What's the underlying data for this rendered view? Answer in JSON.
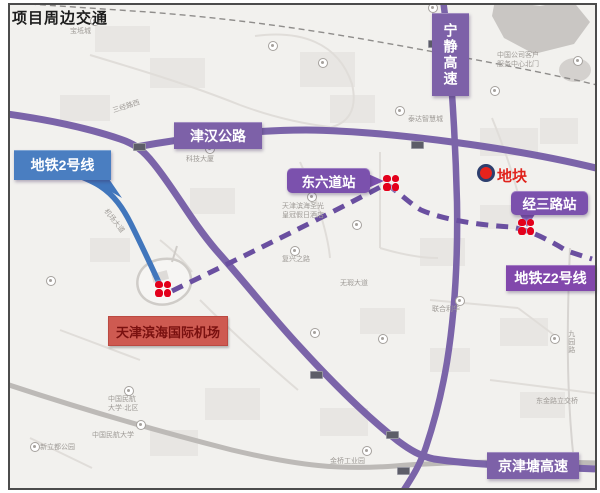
{
  "title": "项目周边交通",
  "labels": {
    "metro_line2": "地铁2号线",
    "jinhan_highway": "津汉公路",
    "ningjing_expressway": "宁静高速",
    "dongliudao_station": "东六道站",
    "plot": "地块",
    "jingsanlu_station": "经三路站",
    "metro_line_z2": "地铁Z2号线",
    "airport": "天津滨海国际机场",
    "jingjintang_expressway": "京津塘高速"
  },
  "colors": {
    "road_purple": "#7b64a9",
    "label_purple": "#7d61a8",
    "label_violet": "#8248ac",
    "callout_purple": "#7b51ad",
    "metro_blue": "#4176bc",
    "metro_blue_label": "#4a7ec1",
    "dashed_metro_purple": "#6a4fa0",
    "metro_logo_red": "#e3001b",
    "plot_red": "#e7231c",
    "plot_ring_navy": "#2e3f6e",
    "airport_label_bg": "#ce5a51",
    "airport_label_text": "#7a1110"
  },
  "map_markers": {
    "stations": [
      {
        "name": "airport-metro-station",
        "x": 155,
        "y": 281
      },
      {
        "name": "dongliudao-metro-station",
        "x": 383,
        "y": 175
      },
      {
        "name": "jingsanlu-metro-station",
        "x": 518,
        "y": 219
      }
    ],
    "pins": [
      [
        90,
        16
      ],
      [
        268,
        41
      ],
      [
        318,
        58
      ],
      [
        428,
        3
      ],
      [
        490,
        86
      ],
      [
        205,
        144
      ],
      [
        307,
        192
      ],
      [
        352,
        220
      ],
      [
        290,
        246
      ],
      [
        46,
        276
      ],
      [
        116,
        326
      ],
      [
        124,
        386
      ],
      [
        136,
        420
      ],
      [
        310,
        328
      ],
      [
        378,
        334
      ],
      [
        550,
        334
      ],
      [
        362,
        446
      ],
      [
        538,
        456
      ],
      [
        30,
        442
      ],
      [
        395,
        106
      ],
      [
        455,
        296
      ],
      [
        573,
        56
      ]
    ],
    "shields": [
      [
        133,
        143
      ],
      [
        428,
        40
      ],
      [
        310,
        371
      ],
      [
        386,
        431
      ],
      [
        397,
        467
      ],
      [
        411,
        141
      ]
    ],
    "pois": [
      {
        "x": 70,
        "y": 28,
        "lines": [
          "宝坻城"
        ]
      },
      {
        "x": 186,
        "y": 156,
        "lines": [
          "科技大厦"
        ]
      },
      {
        "x": 300,
        "y": 170,
        "lines": [
          "城市广场"
        ]
      },
      {
        "x": 282,
        "y": 203,
        "lines": [
          "天津滨海圣光",
          "皇冠假日酒店"
        ]
      },
      {
        "x": 497,
        "y": 52,
        "lines": [
          "中国公司客户",
          "服务中心北门"
        ]
      },
      {
        "x": 432,
        "y": 306,
        "lines": [
          "联合利华"
        ]
      },
      {
        "x": 108,
        "y": 396,
        "lines": [
          "中国民航",
          "大学·北区"
        ]
      },
      {
        "x": 92,
        "y": 432,
        "lines": [
          "中国民航大学"
        ]
      },
      {
        "x": 330,
        "y": 458,
        "lines": [
          "金桥工业园"
        ]
      },
      {
        "x": 282,
        "y": 256,
        "lines": [
          "复兴之路"
        ]
      },
      {
        "x": 340,
        "y": 280,
        "lines": [
          "无瑕大道"
        ]
      },
      {
        "x": 40,
        "y": 444,
        "lines": [
          "新立都公园"
        ]
      },
      {
        "x": 408,
        "y": 116,
        "lines": [
          "泰达智慧城"
        ]
      },
      {
        "x": 536,
        "y": 398,
        "lines": [
          "东金路立交桥"
        ]
      },
      {
        "x": 112,
        "y": 108,
        "lines": [
          "三经路西"
        ],
        "rotate": -18
      },
      {
        "x": 108,
        "y": 208,
        "lines": [
          "机场大道"
        ],
        "rotate": 52
      },
      {
        "x": 566,
        "y": 330,
        "lines": [
          "九园路"
        ],
        "vertical": true
      }
    ]
  }
}
